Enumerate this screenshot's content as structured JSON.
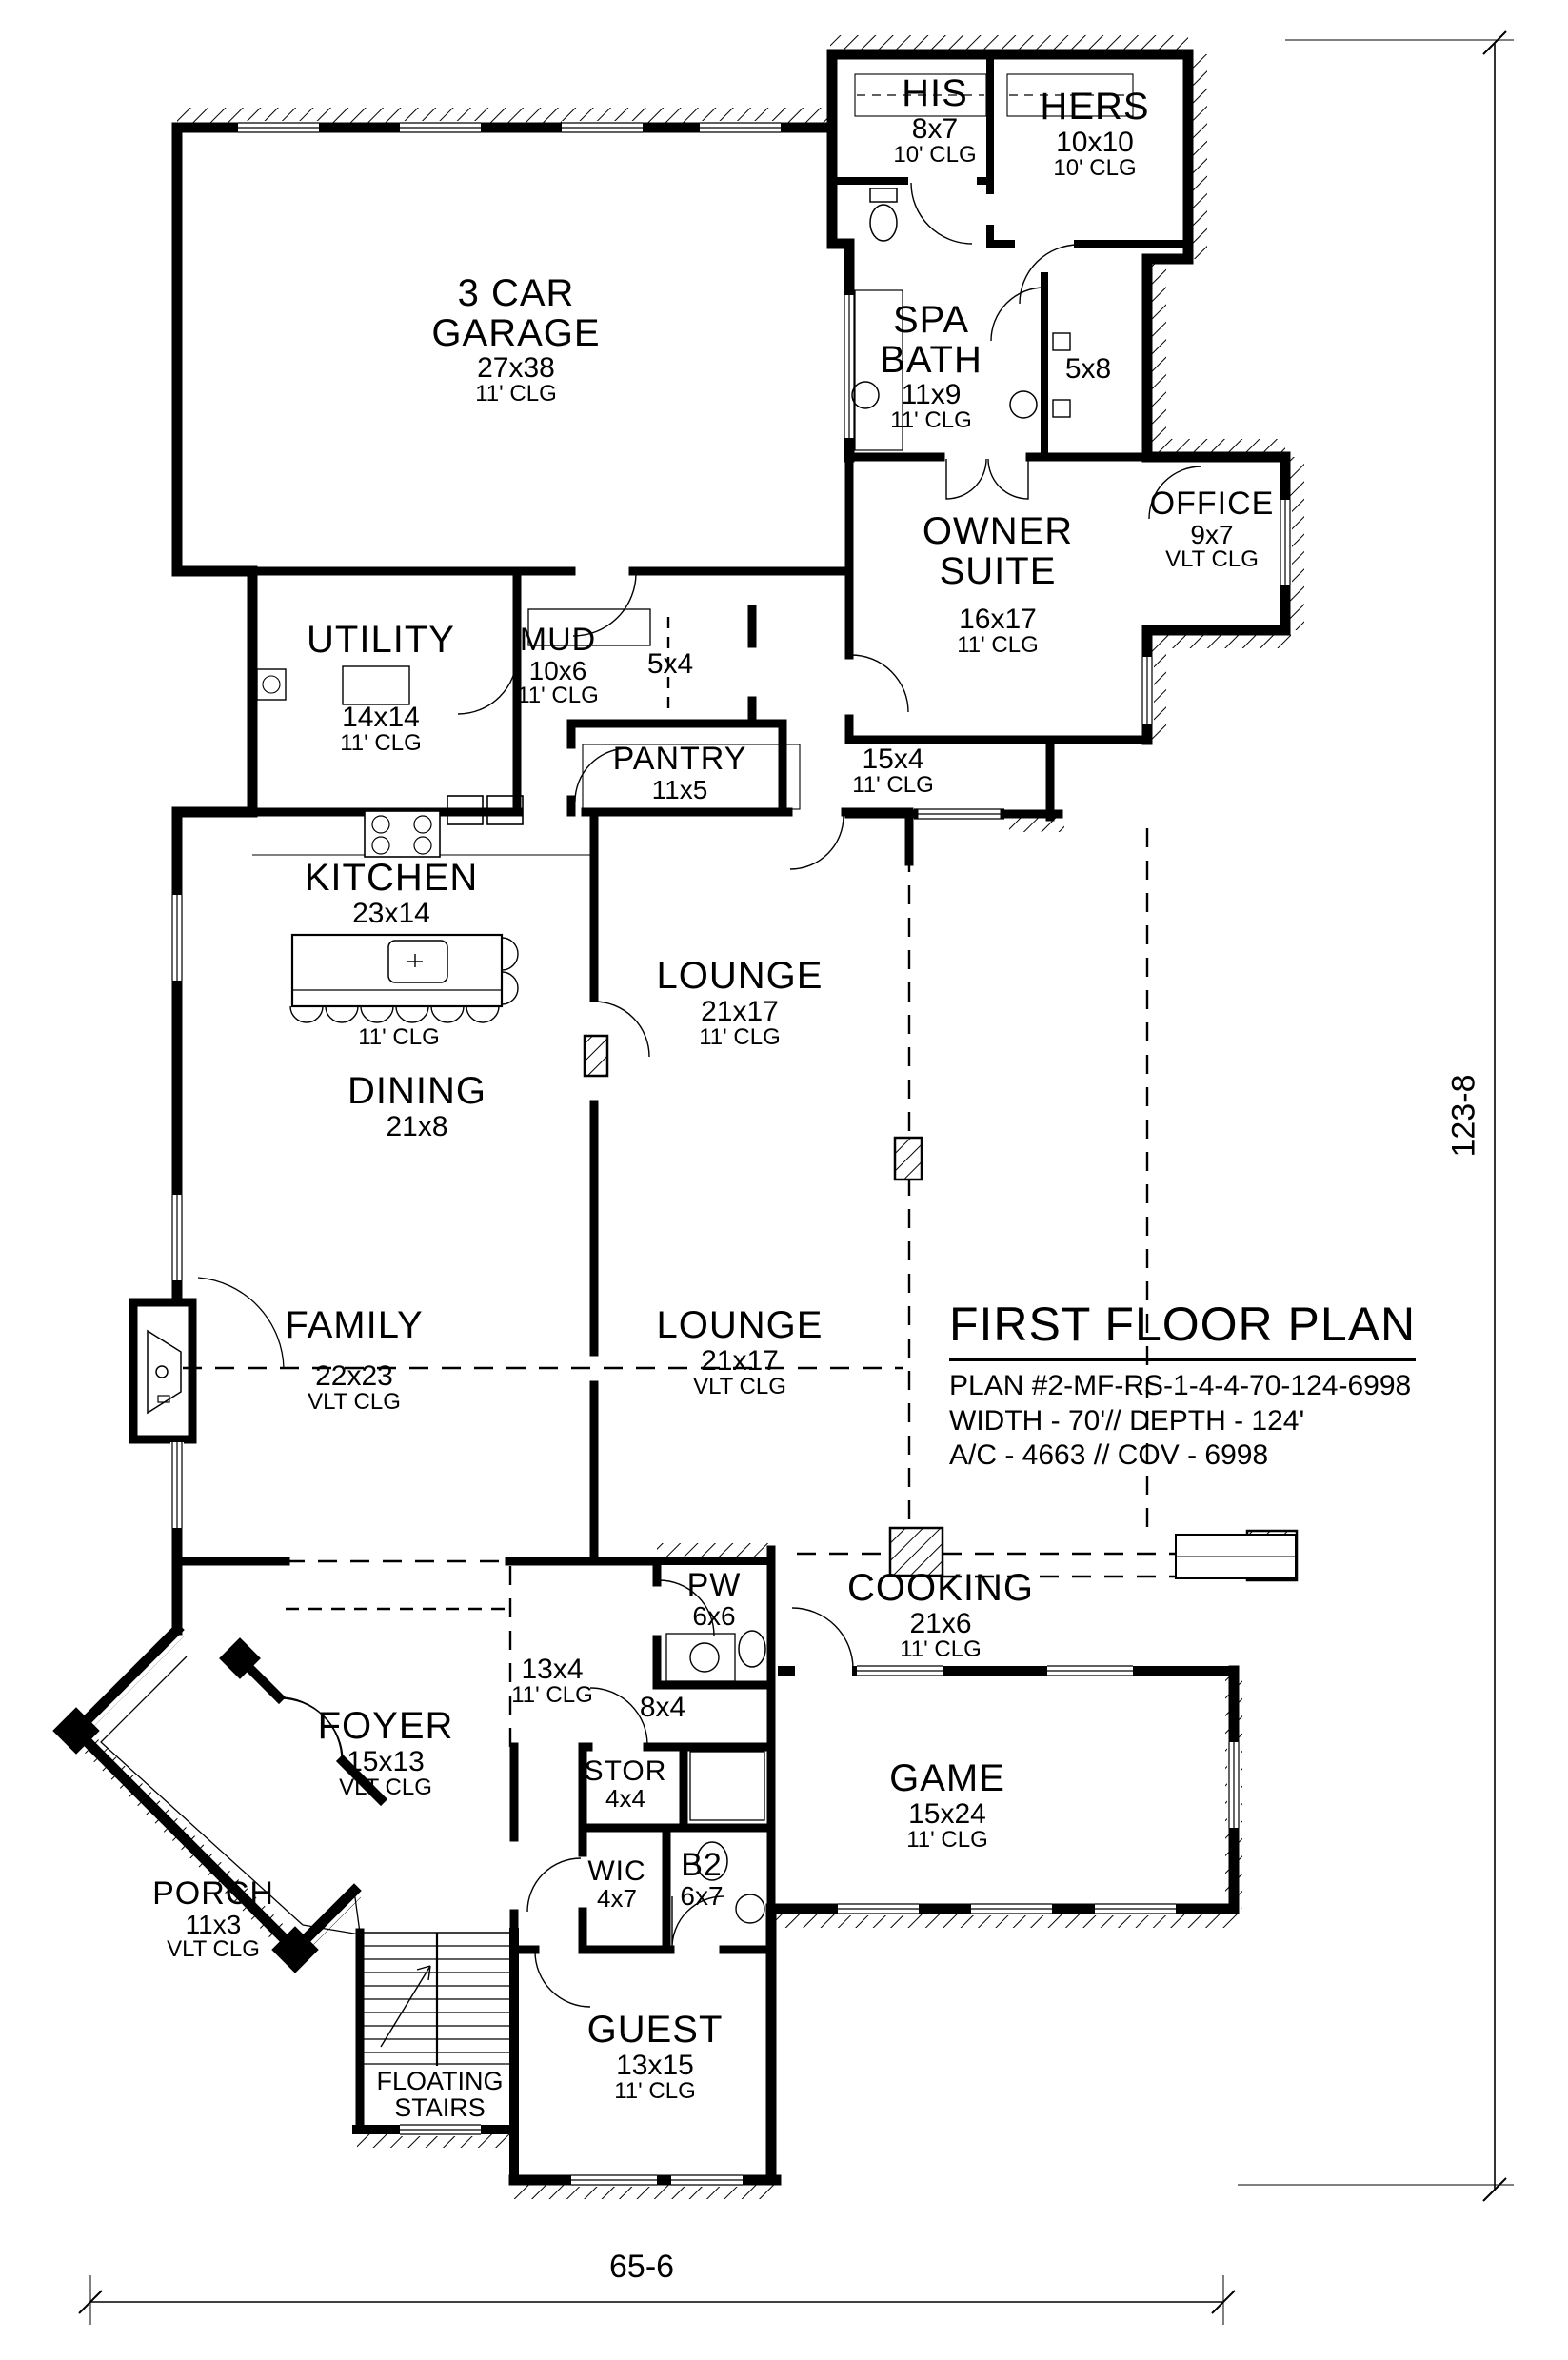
{
  "title_block": {
    "title": "FIRST FLOOR PLAN",
    "line1": "PLAN #2-MF-RS-1-4-4-70-124-6998",
    "line2": "WIDTH - 70'// DEPTH - 124'",
    "line3": "A/C - 4663 // COV - 6998"
  },
  "dimensions": {
    "right": "123-8",
    "bottom": "65-6"
  },
  "rooms": [
    {
      "name": "3 CAR",
      "name2": "GARAGE",
      "dims": "27x38",
      "clg": "11' CLG"
    },
    {
      "name": "HIS",
      "dims": "8x7",
      "clg": "10' CLG"
    },
    {
      "name": "HERS",
      "dims": "10x10",
      "clg": "10' CLG"
    },
    {
      "name": "SPA",
      "name2": "BATH",
      "dims": "11x9",
      "clg": "11' CLG"
    },
    {
      "dims": "5x8"
    },
    {
      "name": "OWNER",
      "name2": "SUITE",
      "dims": "16x17",
      "clg": "11' CLG"
    },
    {
      "name": "OFFICE",
      "dims": "9x7",
      "clg": "VLT CLG"
    },
    {
      "name": "UTILITY",
      "dims": "14x14",
      "clg": "11' CLG"
    },
    {
      "name": "MUD",
      "dims": "10x6",
      "clg": "11' CLG"
    },
    {
      "dims": "5x4"
    },
    {
      "name": "PANTRY",
      "dims": "11x5"
    },
    {
      "dims": "15x4",
      "clg": "11' CLG"
    },
    {
      "name": "KITCHEN",
      "dims": "23x14",
      "clg": "11' CLG"
    },
    {
      "name": "DINING",
      "dims": "21x8"
    },
    {
      "name": "LOUNGE",
      "dims": "21x17",
      "clg": "11' CLG"
    },
    {
      "name": "FAMILY",
      "dims": "22x23",
      "clg": "VLT CLG"
    },
    {
      "name": "LOUNGE",
      "dims": "21x17",
      "clg": "VLT CLG"
    },
    {
      "name": "PW",
      "dims": "6x6"
    },
    {
      "name": "COOKING",
      "dims": "21x6",
      "clg": "11' CLG"
    },
    {
      "dims": "13x4",
      "clg": "11' CLG"
    },
    {
      "dims": "8x4"
    },
    {
      "name": "FOYER",
      "dims": "15x13",
      "clg": "VLT CLG"
    },
    {
      "name": "STOR",
      "dims": "4x4"
    },
    {
      "name": "GAME",
      "dims": "15x24",
      "clg": "11' CLG"
    },
    {
      "name": "WIC",
      "dims": "4x7"
    },
    {
      "name": "B2",
      "dims": "6x7"
    },
    {
      "name": "PORCH",
      "dims": "11x3",
      "clg": "VLT CLG"
    },
    {
      "name": "GUEST",
      "dims": "13x15",
      "clg": "11' CLG"
    },
    {
      "name": "FLOATING",
      "name2": "STAIRS"
    }
  ]
}
